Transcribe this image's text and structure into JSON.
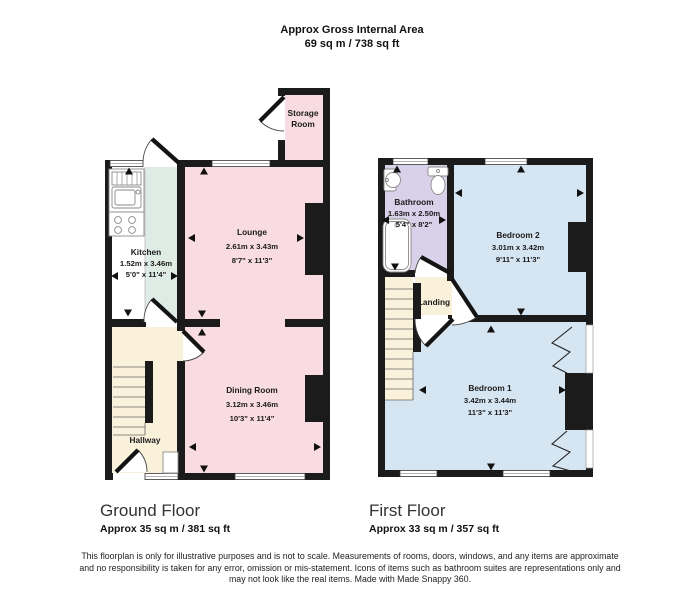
{
  "title": {
    "line1": "Approx Gross Internal Area",
    "line2": "69 sq m / 738 sq ft"
  },
  "ground_floor": {
    "label": "Ground Floor",
    "area": "Approx 35 sq m / 381 sq ft",
    "rooms": {
      "kitchen": {
        "name": "Kitchen",
        "metric": "1.52m x 3.46m",
        "imperial": "5'0\" x 11'4\""
      },
      "lounge": {
        "name": "Lounge",
        "metric": "2.61m x 3.43m",
        "imperial": "8'7\" x 11'3\""
      },
      "dining": {
        "name": "Dining Room",
        "metric": "3.12m x 3.46m",
        "imperial": "10'3\" x 11'4\""
      },
      "hallway": {
        "name": "Hallway"
      },
      "storage": {
        "name_line1": "Storage",
        "name_line2": "Room"
      }
    }
  },
  "first_floor": {
    "label": "First Floor",
    "area": "Approx 33 sq m / 357 sq ft",
    "rooms": {
      "bathroom": {
        "name": "Bathroom",
        "metric": "1.63m x 2.50m",
        "imperial": "5'4\" x 8'2\""
      },
      "bedroom2": {
        "name": "Bedroom 2",
        "metric": "3.01m x 3.42m",
        "imperial": "9'11\" x 11'3\""
      },
      "bedroom1": {
        "name": "Bedroom 1",
        "metric": "3.42m x 3.44m",
        "imperial": "11'3\" x 11'3\""
      },
      "landing": {
        "name": "Landing"
      }
    }
  },
  "disclaimer": {
    "line1": "This floorplan is only for illustrative purposes and is not to scale. Measurements of rooms, doors, windows, and any items are approximate",
    "line2": "and no responsibility is taken for any error, omission or mis-statement. Icons of items such as bathroom suites are representations only and",
    "line3": "may not look like the real items. Made with Made Snappy 360."
  },
  "colors": {
    "room_pink": "#f8dce2",
    "room_mint": "#dfece6",
    "room_cream": "#faf1da",
    "room_lavender": "#d9d0e9",
    "room_blue": "#d6e5f2",
    "wall": "#1b1b1b"
  }
}
